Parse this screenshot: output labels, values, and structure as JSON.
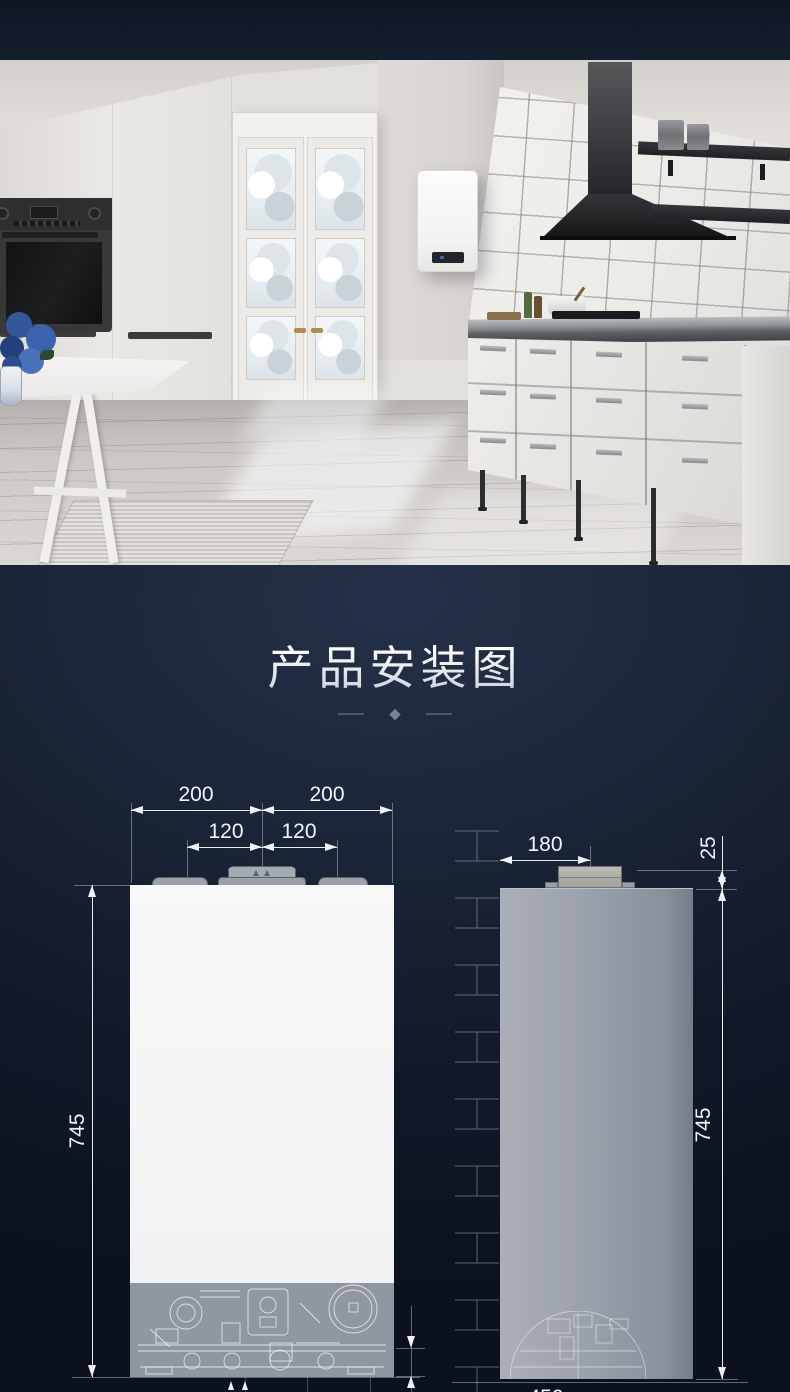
{
  "section": {
    "title": "产品安装图"
  },
  "divider": {
    "glyph": "◆"
  },
  "front_view": {
    "dim_top_left": "200",
    "dim_top_right": "200",
    "dim_mid_left": "120",
    "dim_mid_right": "120",
    "dim_height": "745"
  },
  "side_view": {
    "dim_depth": "180",
    "dim_collar": "25",
    "dim_height": "745",
    "dim_bottom": "450"
  },
  "colors": {
    "section_bg": "#141d2e",
    "dim_line": "#e9edf2",
    "front_body": "#f2f3f4",
    "side_body": "#9aa0aa",
    "accent_blue_flowers": "#3b63ad"
  }
}
